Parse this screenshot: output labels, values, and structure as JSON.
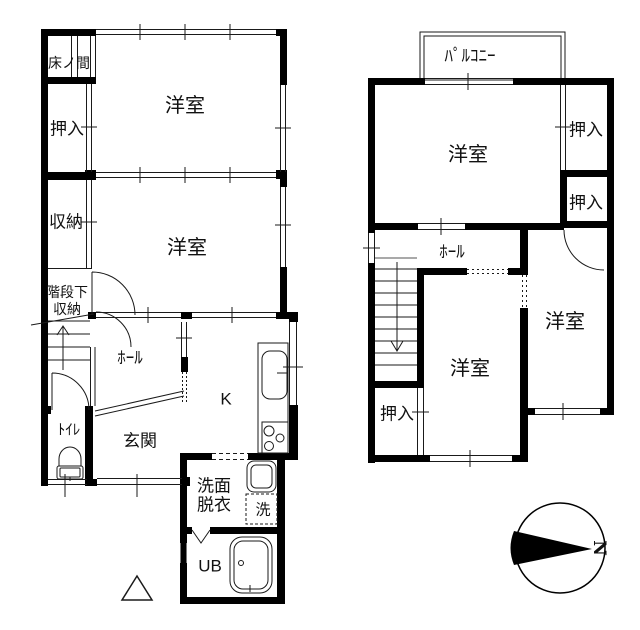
{
  "floor1": {
    "tokonoma": "床ノ間",
    "closet_n": "押入",
    "room_n": "洋室",
    "storage": "収納",
    "room_c": "洋室",
    "understair1": "階段下",
    "understair2": "収納",
    "hall": "ﾎｰﾙ",
    "toilet": "ﾄｲﾚ",
    "entrance": "玄関",
    "kitchen": "K",
    "wash1": "洗面",
    "wash2": "脱衣",
    "laundry": "洗",
    "bath": "UB"
  },
  "floor2": {
    "balcony": "ﾊﾟﾙｺﾆｰ",
    "room_n": "洋室",
    "closet_e1": "押入",
    "closet_e2": "押入",
    "hall": "ﾎｰﾙ",
    "room_c": "洋室",
    "room_e": "洋室",
    "closet_sw": "押入"
  },
  "compass": {
    "north": "N"
  },
  "colors": {
    "wall": "#000000",
    "line": "#1a1a1a",
    "background": "#ffffff"
  }
}
